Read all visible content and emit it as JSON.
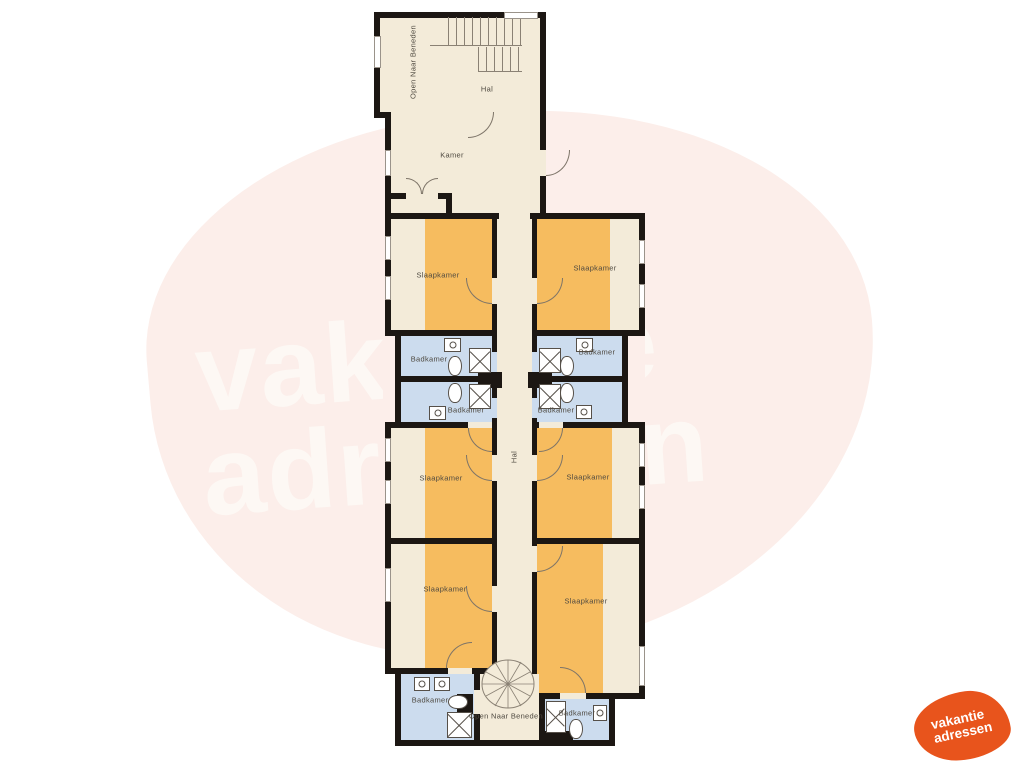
{
  "watermark": {
    "line1": "vakantie",
    "line2": "adressen"
  },
  "logo": {
    "line1": "vakantie",
    "line2": "adressen"
  },
  "colors": {
    "wall": "#1c1713",
    "floor": "#f3ebd9",
    "bedroom_fill": "#f6bc5f",
    "bathroom_fill": "#ccdcee",
    "watermark_background": "#fceeea",
    "watermark_text": "#fdf8f4",
    "logo_background": "#e8541c"
  },
  "plan": {
    "labels": {
      "open_top": "Open Naar Beneden",
      "hal_top": "Hal",
      "kamer": "Kamer",
      "slaapkamer_tl": "Slaapkamer",
      "slaapkamer_tr": "Slaapkamer",
      "badkamer_lu": "Badkamer",
      "badkamer_ru": "Badkamer",
      "badkamer_ll": "Badkamer",
      "badkamer_rl": "Badkamer",
      "hal_corridor": "Hal",
      "slaapkamer_ml": "Slaapkamer",
      "slaapkamer_mr": "Slaapkamer",
      "slaapkamer_bl": "Slaapkamer",
      "slaapkamer_br": "Slaapkamer",
      "badkamer_bl": "Badkamer",
      "open_bottom": "Open Naar Beneden",
      "badkamer_br": "Badkamer"
    }
  }
}
